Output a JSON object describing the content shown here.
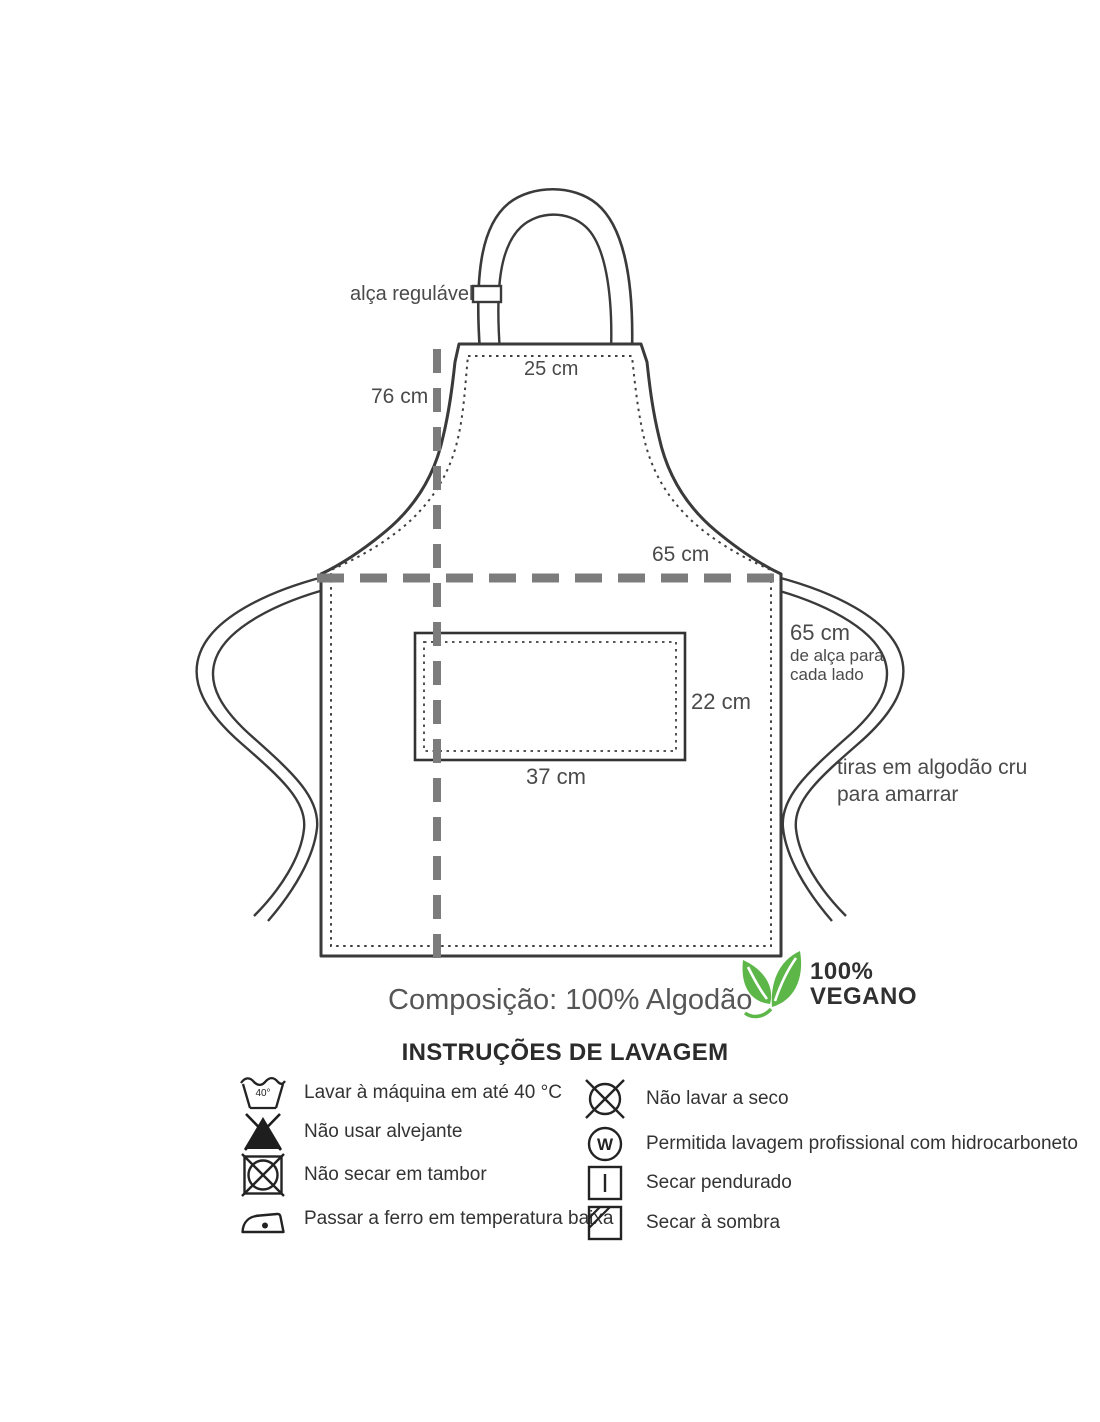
{
  "diagram": {
    "strap_adjustable": "alça regulável",
    "top_width": "25 cm",
    "height": "76 cm",
    "waist_width": "65 cm",
    "tie_length_line1": "65 cm",
    "tie_length_line2": "de alça para",
    "tie_length_line3": "cada lado",
    "pocket_height": "22 cm",
    "pocket_width": "37 cm",
    "ties_note_line1": "tiras em algodão cru",
    "ties_note_line2": "para amarrar"
  },
  "composition": "Composição: 100% Algodão",
  "vegan_badge": {
    "percent": "100%",
    "label": "VEGANO",
    "green": "#5cb648"
  },
  "care": {
    "title": "INSTRUÇÕES DE LAVAGEM",
    "left": [
      {
        "icon": "machine-wash-40-icon",
        "icon_text": "40°",
        "label": "Lavar à máquina em até 40 °C"
      },
      {
        "icon": "no-bleach-icon",
        "label": "Não usar alvejante"
      },
      {
        "icon": "no-tumble-dry-icon",
        "label": "Não secar em tambor"
      },
      {
        "icon": "iron-low-temperature-icon",
        "label": "Passar a ferro em temperatura baixa"
      }
    ],
    "right": [
      {
        "icon": "no-dry-clean-icon",
        "label": "Não lavar a seco"
      },
      {
        "icon": "professional-wet-clean-icon",
        "icon_text": "W",
        "label": "Permitida lavagem profissional com hidrocarboneto"
      },
      {
        "icon": "hang-dry-icon",
        "label": "Secar pendurado"
      },
      {
        "icon": "dry-in-shade-icon",
        "label": "Secar à sombra"
      }
    ]
  }
}
